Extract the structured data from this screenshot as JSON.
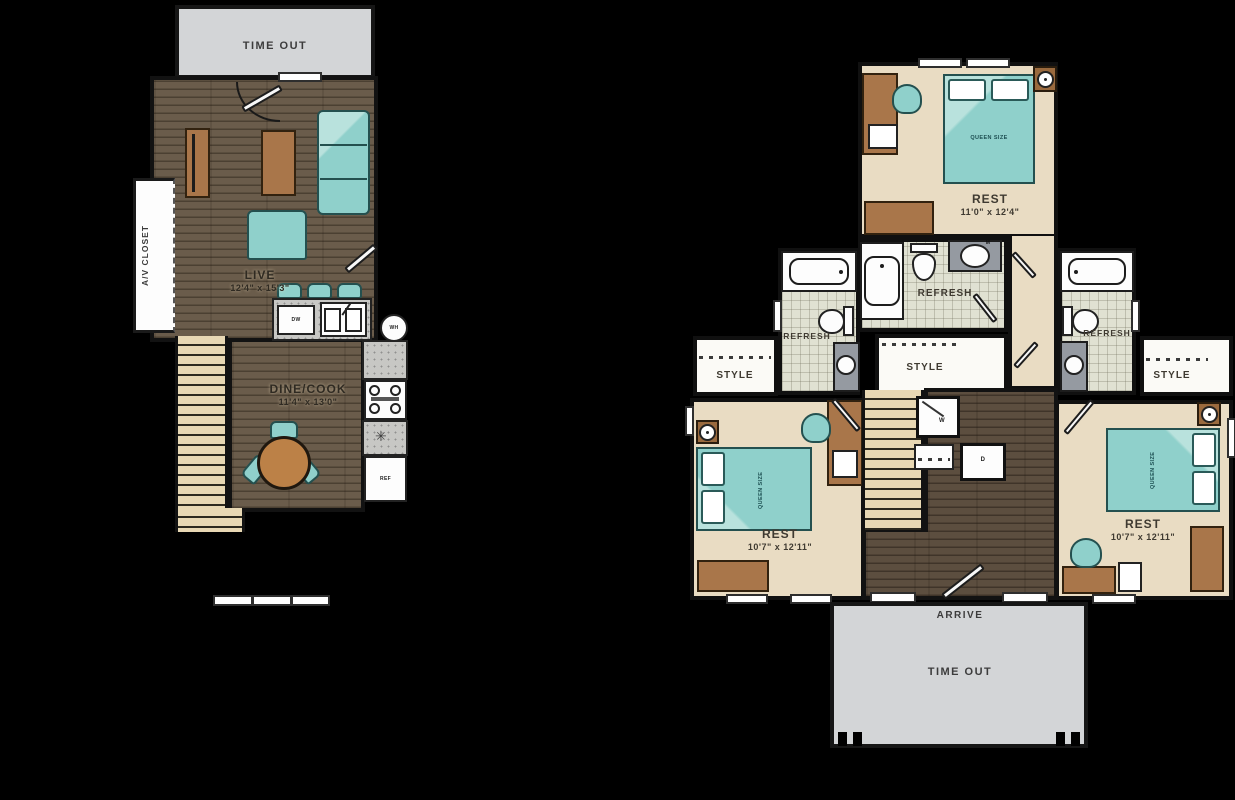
{
  "floor1": {
    "deck": {
      "label": "TIME OUT"
    },
    "living": {
      "name": "LIVE",
      "dims": "12'4\" x 15'3\""
    },
    "dining": {
      "name": "DINE/COOK",
      "dims": "11'4\" x 13'0\""
    },
    "av_closet": {
      "label": "A/V CLOSET"
    },
    "dishwasher": "DW",
    "fridge": "REF",
    "water_heater": "WH"
  },
  "floor2": {
    "bedroom_top": {
      "name": "REST",
      "dims": "11'0\" x 12'4\"",
      "bed": "QUEEN SIZE"
    },
    "bedroom_left": {
      "name": "REST",
      "dims": "10'7\" x 12'11\"",
      "bed": "QUEEN SIZE"
    },
    "bedroom_right": {
      "name": "REST",
      "dims": "10'7\" x 12'11\"",
      "bed": "QUEEN SIZE"
    },
    "bath_left": {
      "name": "REFRESH"
    },
    "bath_mid": {
      "name": "REFRESH"
    },
    "bath_right": {
      "name": "REFRESH"
    },
    "closet_left": {
      "name": "STYLE"
    },
    "closet_mid": {
      "name": "STYLE"
    },
    "closet_right": {
      "name": "STYLE"
    },
    "entry": {
      "label": "ARRIVE"
    },
    "deck": {
      "label": "TIME OUT"
    },
    "washer": "W",
    "dryer": "D",
    "mirror_tag": "M"
  },
  "colors": {
    "background": "#000000",
    "wood_floor": "#6a5c4b",
    "hall_wood": "#5c4e3f",
    "bedroom_floor": "#e9dcc3",
    "bath_tile": "#e0e1d2",
    "deck_gray": "#d3d5d7",
    "teal_furniture": "#8fd0cb",
    "brown_furniture": "#a9764a",
    "stair_tread": "#e8d8b4",
    "fixture_white": "#fdfdfd",
    "vanity_gray": "#959aa1"
  }
}
